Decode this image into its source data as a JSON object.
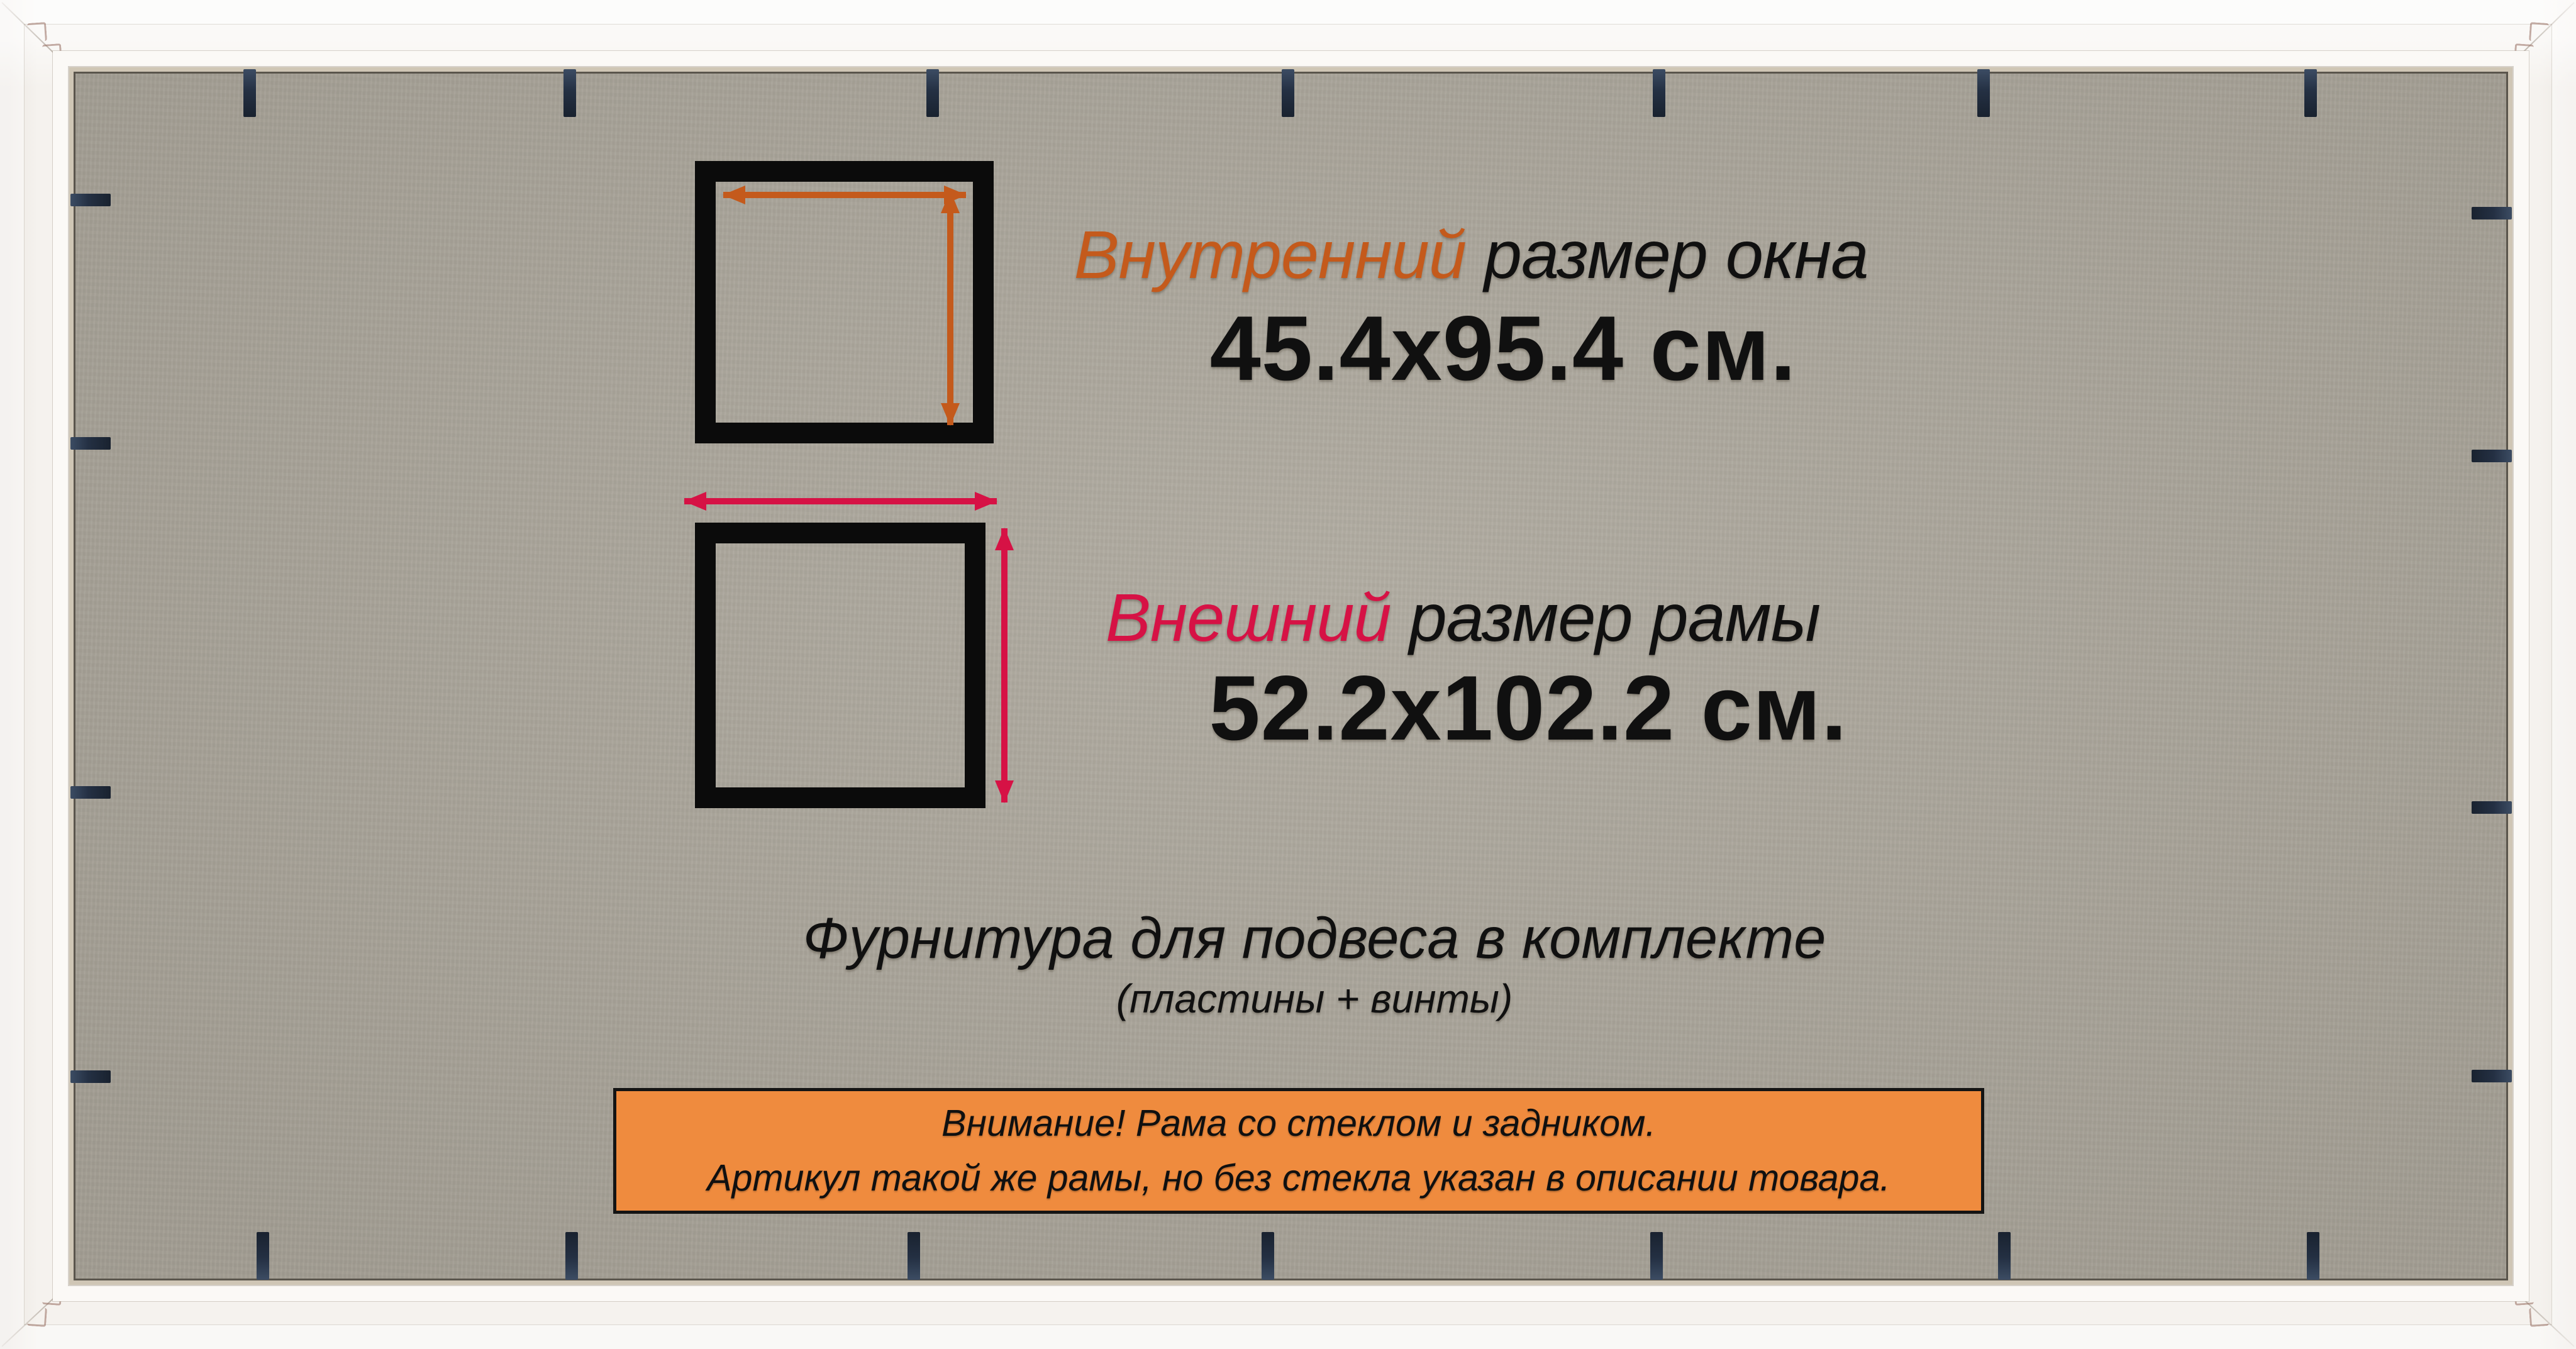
{
  "labels": {
    "inner": {
      "accent": "Внутренний",
      "rest": " размер окна",
      "value": "45.4x95.4 см."
    },
    "outer": {
      "accent": "Внешний",
      "rest": " размер рамы",
      "value": "52.2x102.2 см."
    },
    "hardware": {
      "line1": "Фурнитура для подвеса в комплекте",
      "line2": "(пластины + винты)"
    },
    "notice": {
      "line1": "Внимание! Рама со стеклом и задником.",
      "line2": "Артикул такой же рамы, но без стекла указан в описании товара."
    }
  },
  "colors": {
    "inner_accent": "#c45a1c",
    "outer_accent": "#d61245",
    "notice_fill": "#ef8b3e",
    "notice_border": "#141414",
    "text": "#101010",
    "board": "#aca79b",
    "frame_white": "#f5f2ee",
    "clip": "#243043"
  },
  "decor": {
    "clips_top_x": [
      397,
      906,
      1483,
      2048,
      2638,
      3154,
      3674
    ],
    "clips_bottom_x": [
      418,
      909,
      1453,
      2016,
      2634,
      3187,
      3678
    ],
    "clips_left_y": [
      318,
      705,
      1260,
      1712
    ],
    "clips_right_y": [
      339,
      725,
      1284,
      1711
    ],
    "hooks_tl": [
      [
        44,
        36
      ],
      [
        68,
        70
      ],
      [
        94,
        102
      ]
    ],
    "hooks_tr": [
      [
        4022,
        36
      ],
      [
        3998,
        70
      ],
      [
        3972,
        102
      ]
    ],
    "hooks_bl": [
      [
        44,
        2079
      ],
      [
        68,
        2045
      ],
      [
        94,
        2013
      ]
    ],
    "hooks_br": [
      [
        4022,
        2079
      ],
      [
        3998,
        2045
      ],
      [
        3972,
        2013
      ]
    ]
  }
}
